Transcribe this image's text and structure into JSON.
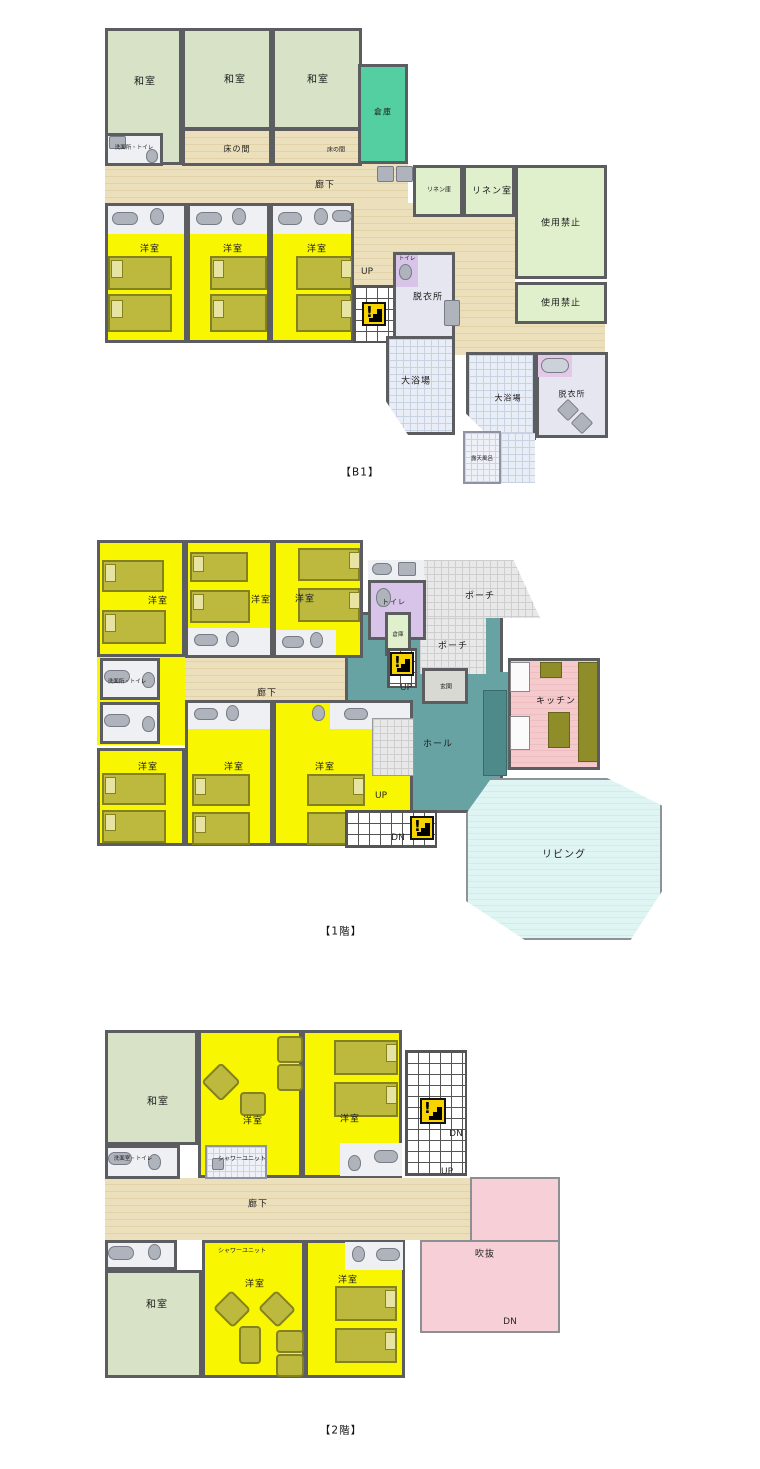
{
  "icons": {
    "stairs_warning": "!"
  },
  "floors": [
    {
      "caption": "【B1】",
      "labels": {
        "washitsu": "和室",
        "souko": "倉庫",
        "tokonoma": "床の間",
        "senmen_toilet": "洗面所・トイレ",
        "rouka": "廊下",
        "linen_ko": "リネン庫",
        "linen_room": "リネン室",
        "kinshi": "使用禁止",
        "yoshitsu": "洋室",
        "up": "UP",
        "toilet": "トイレ",
        "datsuijo": "脱衣所",
        "daiyokujo": "大浴場",
        "rotenburo": "露天風呂"
      }
    },
    {
      "caption": "【1階】",
      "labels": {
        "yoshitsu": "洋室",
        "toilet": "トイレ",
        "souko": "倉庫",
        "porch": "ポーチ",
        "genkan": "玄関",
        "kitchen": "キッチン",
        "hall": "ホール",
        "rouka": "廊下",
        "senmen_toilet": "洗面所・トイレ",
        "up": "UP",
        "dn": "DN",
        "living": "リビング"
      }
    },
    {
      "caption": "【2階】",
      "labels": {
        "washitsu": "和室",
        "yoshitsu": "洋室",
        "senmen_toilet": "洗面室・トイレ",
        "shower": "シャワーユニット",
        "rouka": "廊下",
        "up": "UP",
        "dn": "DN",
        "fukinuke": "吹抜"
      }
    }
  ]
}
